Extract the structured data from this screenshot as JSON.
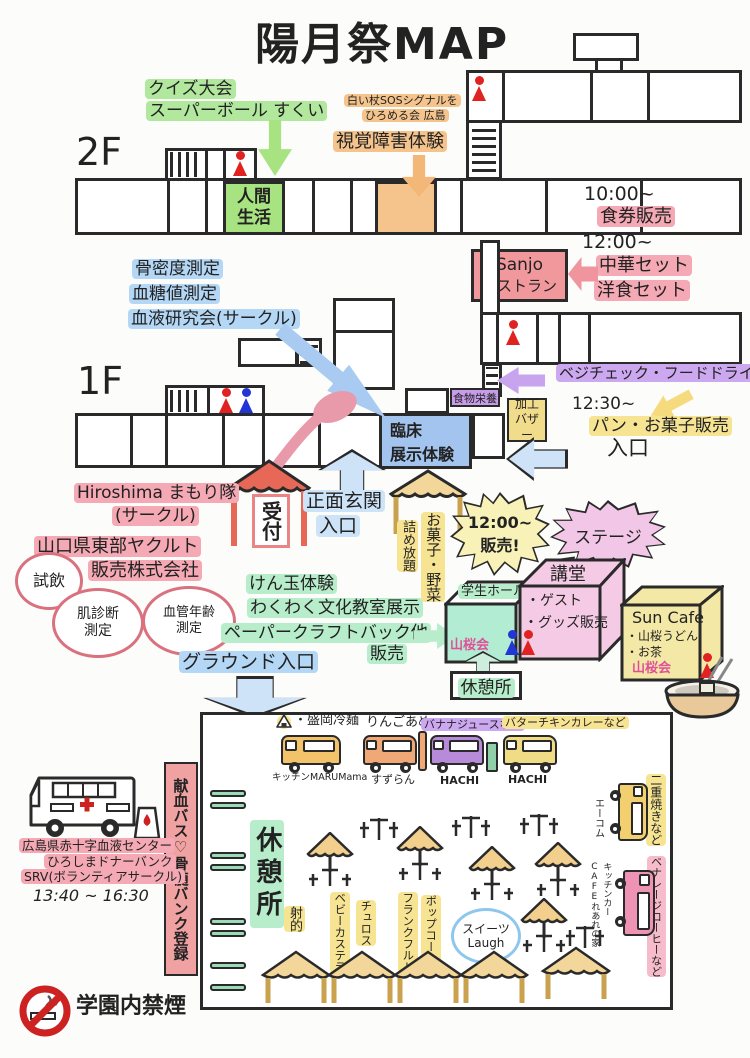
{
  "title": "陽月祭MAP",
  "floor2": {
    "label": "2F",
    "quiz": "クイズ大会",
    "superball": "スーパーボール すくい",
    "sos_line1": "白い杖SOSシグナルを",
    "sos_line2": "ひろめる会 広島",
    "visual_impairment": "視覚障害体験",
    "human_life_room": "人間生活"
  },
  "floor1": {
    "label": "1F",
    "bone_density": "骨密度測定",
    "blood_sugar": "血糖値測定",
    "blood_research": "血液研究会(サークル)",
    "clinical_line1": "臨床",
    "clinical_line2": "展示体験",
    "food_nutrition": "食物栄養",
    "processing_bazaar": "加工バザー",
    "entrance": "入口"
  },
  "restaurant": {
    "name_line1": "Sanjo",
    "name_line2": "レストラン",
    "time1": "10:00~",
    "ticket_sale": "食券販売",
    "time2": "12:00~",
    "chinese_set": "中華セット",
    "western_set": "洋食セット"
  },
  "vegecheck": "ベジチェック・フードドライブ",
  "bakery": {
    "time": "12:30~",
    "label": "パン・お菓子販売"
  },
  "reception": {
    "label": "受付",
    "main_gate_line1": "正面玄関",
    "main_gate_line2": "入口",
    "hiroshima_line1": "Hiroshima まもり隊",
    "hiroshima_line2": "(サークル)",
    "yakult_line1": "山口県東部ヤクルト",
    "yakult_line2": "販売株式会社"
  },
  "bubbles": {
    "tasting": "試飲",
    "skin_line1": "肌診断",
    "skin_line2": "測定",
    "vessel_line1": "血管年齢",
    "vessel_line2": "測定"
  },
  "culture": {
    "kendama": "けん玉体験",
    "classroom": "わくわく文化教室展示",
    "papercraft": "ペーパークラフトバック他",
    "sale": "販売"
  },
  "ground_gate": "グラウンド入口",
  "snack_tent": {
    "line1": "お菓子・野菜",
    "line2": "詰め放題"
  },
  "noon_sale": {
    "line1": "12:00~",
    "line2": "販売!"
  },
  "stage": "ステージ",
  "halls": {
    "student_hall": "学生ホール",
    "yamazakura": "山桜会",
    "auditorium": "講堂",
    "guest": "・ゲスト",
    "goods": "・グッズ販売",
    "sun_cafe": "Sun Cafe",
    "udon": "・山桜うどん",
    "tea": "・お茶",
    "yamazakura2": "山桜会",
    "rest_area": "休憩所"
  },
  "ground": {
    "trucks": [
      {
        "menu": "・盛岡冷麺",
        "name": "キッチンMARUMama"
      },
      {
        "menu": "りんごあめ",
        "name": "すずらん"
      },
      {
        "menu": "バナナジュースなど",
        "name": "HACHI"
      },
      {
        "menu": "バターチキンカレーなど",
        "name": "HACHI"
      }
    ],
    "side_trucks": [
      {
        "menu": "二重焼きなど",
        "name": "エーコム"
      },
      {
        "menu": "ベナレージコーヒーなど",
        "name_line1": "キッチンカー",
        "name_line2": "CAFEれあれの家"
      }
    ],
    "rest_area": "休憩所",
    "stalls": [
      "射的",
      "ベビーカステラ",
      "チュロス",
      "フランクフルト",
      "ポップコーン"
    ],
    "sweets_line1": "スイーツ",
    "sweets_line2": "Laugh"
  },
  "blood_drive": {
    "banner": "献血バス♡骨髄バンク登録",
    "center": "広島県赤十字血液センター",
    "donor_bank": "ひろしまドナーバンク",
    "srv": "SRV(ボランティアサークル)",
    "time": "13:40 ~ 16:30"
  },
  "no_smoking": "学園内禁煙",
  "colors": {
    "highlight_pink": "#f4a9b4",
    "highlight_green": "#b2e89e",
    "highlight_orange": "#f5c48d",
    "highlight_blue": "#b3d7f5",
    "highlight_yellow": "#f7e493",
    "highlight_purple": "#cca8f0",
    "room_green": "#a8e381",
    "box_pink": "#f0989c",
    "box_blue": "#a3c4ee",
    "person_red": "#e02222",
    "person_blue": "#2236d6",
    "no_smoking_red": "#cc2222"
  }
}
